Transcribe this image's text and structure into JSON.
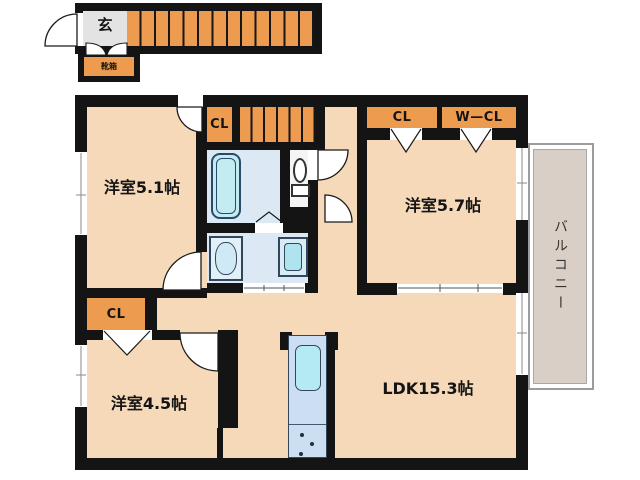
{
  "plan_title": "2F floor plan",
  "entrance": {
    "label": "玄",
    "shoebox_label": "靴箱"
  },
  "rooms": {
    "west_room_51": {
      "label": "洋室5.1帖"
    },
    "west_room_57": {
      "label": "洋室5.7帖"
    },
    "west_room_45": {
      "label": "洋室4.5帖"
    },
    "ldk": {
      "label": "LDK15.3帖"
    }
  },
  "closets": {
    "hall_closet": "CL",
    "room57_closet": "CL",
    "room57_walkin_closet": "W—CL",
    "room45_closet": "CL"
  },
  "balcony": {
    "label": "バルコニー"
  },
  "colors": {
    "floor": "#f5d9b8",
    "accent_orange": "#ed9b4f",
    "wall": "#141414",
    "wet_area_floor": "#dce9f5",
    "fixture_cyan": "#c2ebf2",
    "kitchen_counter": "#ccdff2",
    "balcony_fill": "#d9cfc6",
    "entrance_floor": "#e3e3e3",
    "background": "#ffffff"
  }
}
